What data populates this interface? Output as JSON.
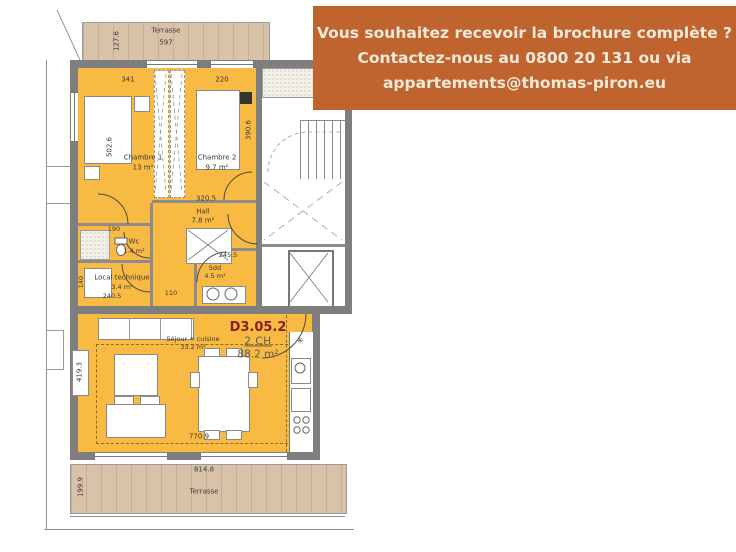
{
  "banner": {
    "line1": "Vous souhaitez recevoir la brochure complète ?",
    "line2": "Contactez-nous au 0800 20 131 ou via",
    "line3": "appartements@thomas-piron.eu"
  },
  "unit": {
    "code": "D3.05.2",
    "bedrooms": "2 CH",
    "total_area": "88.2 m²"
  },
  "rooms": {
    "chambre1": {
      "name": "Chambre 1",
      "area": "13 m²"
    },
    "chambre2": {
      "name": "Chambre 2",
      "area": "9.7 m²"
    },
    "hall": {
      "name": "Hall",
      "area": "7.8 m²"
    },
    "wc": {
      "name": "Wc",
      "area": "1.4 m²"
    },
    "local_technique": {
      "name": "Local technique",
      "area": "3.4 m²"
    },
    "sdd": {
      "name": "Sdd",
      "area": "4.5 m²"
    },
    "sejour": {
      "name": "Séjour + cuisine",
      "area": "33.2 m²"
    },
    "terrasse_top": {
      "name": "Terrasse"
    },
    "terrasse_bottom": {
      "name": "Terrasse"
    }
  },
  "dims": {
    "d597": "597",
    "d127": "127.6",
    "d341": "341",
    "d220": "220",
    "d502": "502.6",
    "d390": "390.6",
    "d320": "320.5",
    "d190": "190",
    "d245": "245.5",
    "d240": "240.5",
    "d110": "110",
    "d140": "140",
    "d419": "419.3",
    "d770": "770.9",
    "d814": "814.8",
    "d199": "199.9"
  },
  "symbols": {
    "kitchen_star": "✳"
  },
  "colors": {
    "apartment_fill": "#f8ba42",
    "terrace_fill": "#d9c3a8",
    "wall": "#7e7e7e",
    "banner_bg": "#c0642f",
    "banner_text": "#f3ead9",
    "unit_code": "#8a1e1e"
  }
}
